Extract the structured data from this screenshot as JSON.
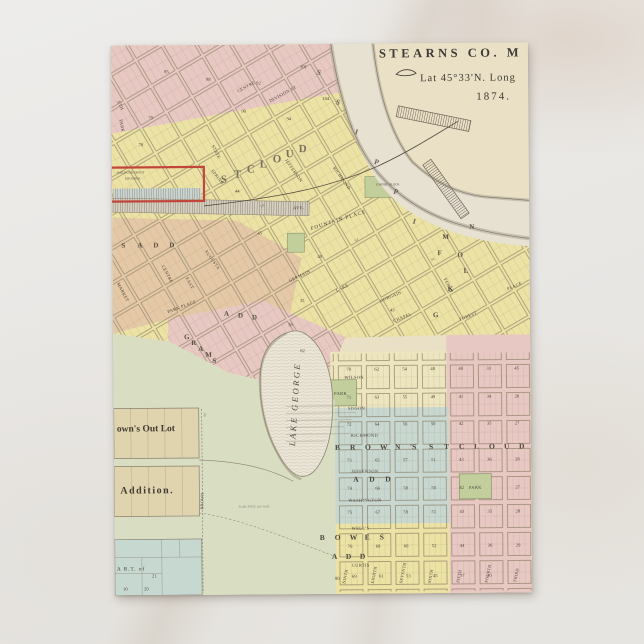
{
  "map": {
    "header": {
      "county": "STEARNS CO. M",
      "latlong": "Lat 45°33'N. Long",
      "year": "1874."
    },
    "river": {
      "letters": [
        "S",
        "S",
        "I",
        "P",
        "P",
        "I"
      ]
    },
    "city_upper": {
      "big_letters": [
        "S",
        "T",
        "C",
        "L",
        "O",
        "U",
        "D"
      ],
      "streets": {
        "centre": "CENTRE",
        "division": "DIVISION ST",
        "state": "STATE",
        "spring": "SPRING",
        "richmond": "RICHMOND",
        "jefferson": "JEFFERSON",
        "market": "MARKET",
        "centre2": "CENTRE",
        "east": "EAST",
        "augusta": "AUGUSTA",
        "germain": "GERMAIN",
        "lake": "LAKE",
        "morgain": "MORGAIN",
        "chapel": "CHAPEL",
        "ferry": "FERRY",
        "forest": "FOREST",
        "place": "PLACE",
        "park_place": "PARK PLACE",
        "fountain_place": "FOUNTAIN PLACE",
        "park": "PARK",
        "eth": "ETH",
        "st": "ST."
      },
      "numbers": [
        "85",
        "88",
        "92",
        "101",
        "104",
        "90",
        "94",
        "79",
        "78",
        "44",
        "45",
        "49",
        "35",
        "38",
        "62",
        "43"
      ],
      "block_letters": [
        "M",
        "N",
        "O",
        "L",
        "F",
        "K",
        "G"
      ],
      "empire_block": "EMPIRE BLOCK",
      "s_add": [
        "S",
        "A",
        "D",
        "D"
      ],
      "grams": [
        "G",
        "R",
        "A",
        "M",
        "S"
      ],
      "add1": [
        "A",
        "D",
        "D"
      ],
      "depot": {
        "line1": "RAILROAD DEPOT",
        "line2": "GROUNDS",
        "ave": "AVE."
      }
    },
    "lake_george": {
      "label": "LAKE GEORGE"
    },
    "west": {
      "out_lot": "own's Out Lot",
      "addition": "Addition.",
      "brown_st": "BROWN",
      "brown_st_st": "ST",
      "scale_note": "Scale 300 ft. per inch.",
      "part": "A R.T. of",
      "part_numbers": [
        "21",
        "10",
        "20"
      ]
    },
    "grid": {
      "h_streets": [
        "WILSON",
        "SISSON",
        "RICHMOND",
        "JEFFERSON",
        "WASHINGTON",
        "WELL'S",
        "CURTIS"
      ],
      "v_streets": [
        "NINTH",
        "EIGHTH",
        "SEVENTH",
        "SIXTH",
        "FIFTH",
        "FOURTH",
        "THIRD"
      ],
      "browns": [
        "B",
        "R",
        "O",
        "W",
        "N",
        "'S"
      ],
      "stcloud": [
        "S",
        "T",
        "C",
        "L",
        "O",
        "U",
        "D"
      ],
      "add": [
        "A",
        "D",
        "D"
      ],
      "bowes": [
        "B",
        "O",
        "W",
        "E",
        "S"
      ],
      "add2": [
        "A",
        "D",
        "D"
      ],
      "park1": "PARK",
      "park2": "PARK",
      "rows": {
        "r1": [
          "70",
          "62",
          "54",
          "48",
          "40",
          "33",
          "45"
        ],
        "r2": [
          "71",
          "63",
          "55",
          "49",
          "41",
          "34",
          "26"
        ],
        "r3": [
          "72",
          "64",
          "56",
          "50",
          "42",
          "35",
          "27"
        ],
        "r4": [
          "73",
          "65",
          "57",
          "51",
          "43",
          "36",
          "28"
        ],
        "r5": [
          "74",
          "66",
          "58",
          "50",
          "42",
          "",
          "27"
        ],
        "r6": [
          "75",
          "67",
          "59",
          "51",
          "43",
          "35",
          "28"
        ],
        "r7": [
          "76",
          "68",
          "60",
          "52",
          "44",
          "36",
          "29"
        ],
        "r8": [
          "69",
          "61",
          "53",
          "45",
          "37",
          "30"
        ],
        "left80": "80"
      }
    },
    "colors": {
      "pink": "#e8c8c2",
      "yellow": "#ebe2a4",
      "salmon": "#e5c9a6",
      "sage": "#d9dec3",
      "cyan": "#c8d7cf",
      "teal": "#c6d8d0",
      "parkgreen": "#c2cf9d",
      "cream": "#e9e0c5",
      "cream2": "#ede5be",
      "water": "#e7e1d2",
      "red": "#c2453c",
      "tan": "#dfd4ae"
    }
  }
}
